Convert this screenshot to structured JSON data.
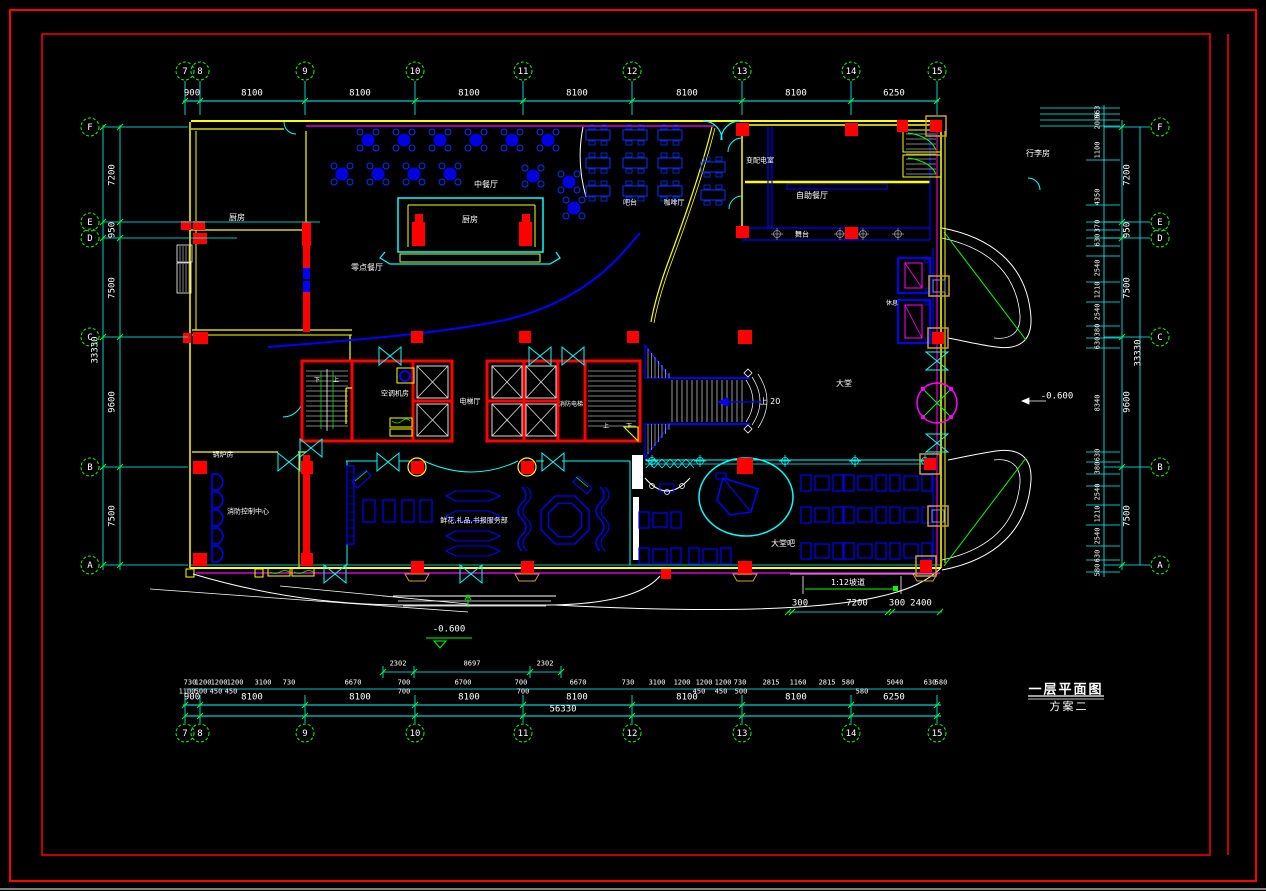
{
  "title": {
    "line1": "一层平面图",
    "line2": "方案二"
  },
  "grid": {
    "top": [
      "7",
      "8",
      "9",
      "10",
      "11",
      "12",
      "13",
      "14",
      "15"
    ],
    "bottom": [
      "7",
      "8",
      "9",
      "10",
      "11",
      "12",
      "13",
      "14",
      "15"
    ],
    "left": [
      "F",
      "E",
      "D",
      "C",
      "B",
      "A"
    ],
    "right": [
      "F",
      "E",
      "D",
      "C",
      "B",
      "A"
    ]
  },
  "dims": {
    "top": [
      "900",
      "8100",
      "8100",
      "8100",
      "8100",
      "8100",
      "8100",
      "6250"
    ],
    "bottom_900": [
      "900",
      "8100",
      "8100",
      "8100",
      "8100",
      "8100",
      "8100",
      "6250"
    ],
    "bottom_total": "56330",
    "bottom_upper": [
      "2302",
      "8697",
      "2302"
    ],
    "bottom_small": [
      "730",
      "1200",
      "1200",
      "1200",
      "3100",
      "730",
      "6670",
      "700",
      "6700",
      "700",
      "6670",
      "730",
      "3100",
      "1200",
      "1200",
      "1200",
      "730",
      "2815",
      "1160",
      "2815",
      "580",
      "5040",
      "630",
      "580"
    ],
    "bottom_small2": [
      "1100",
      "500",
      "450",
      "450",
      "700",
      "700",
      "450",
      "450",
      "500",
      "580"
    ],
    "left_chain": [
      "7200",
      "950",
      "7500",
      "9600",
      "7500"
    ],
    "left_total": "33330",
    "right_chain": [
      "7200",
      "950",
      "7500",
      "9600",
      "7500"
    ],
    "right_total": "33330",
    "right_detail": [
      "563",
      "2000",
      "1100",
      "4350",
      "370",
      "630",
      "2540",
      "1210",
      "2540",
      "380",
      "630",
      "8340",
      "630",
      "380",
      "2540",
      "1210",
      "2540",
      "630",
      "580"
    ],
    "ramp_dims": [
      "300",
      "7200",
      "300",
      "2400"
    ],
    "ramp_label": "1:12坡道",
    "level_front": "-0.600",
    "level_side": "-0.600",
    "stair_up": "上 20"
  },
  "rooms": {
    "kitchen": "厨房",
    "chinese_restaurant": "中餐厅",
    "stage_kitchen": "厨房",
    "alacarte": "零点餐厅",
    "bar": "吧台",
    "cafe": "咖啡厅",
    "power_room": "变配电室",
    "buffet": "自助餐厅",
    "stage": "舞台",
    "luggage": "行李房",
    "ac_room": "空调机房",
    "elev_hall": "电梯厅",
    "fire_elev": "消防电梯",
    "lobby": "大堂",
    "lobby_bar": "大堂吧",
    "shop": "鲜花,礼品,书报服务部",
    "fire_control": "消防控制中心",
    "boiler": "锅炉房",
    "rest": "休息",
    "stair_up_label": "上",
    "stair_down_label": "下"
  },
  "colors": {
    "wall": "#ffff00",
    "grid": "#00ffff",
    "core": "#ff0000",
    "furniture": "#0000ff",
    "accent": "#ff00ff",
    "tick": "#00ff00",
    "text": "#ffffff"
  }
}
